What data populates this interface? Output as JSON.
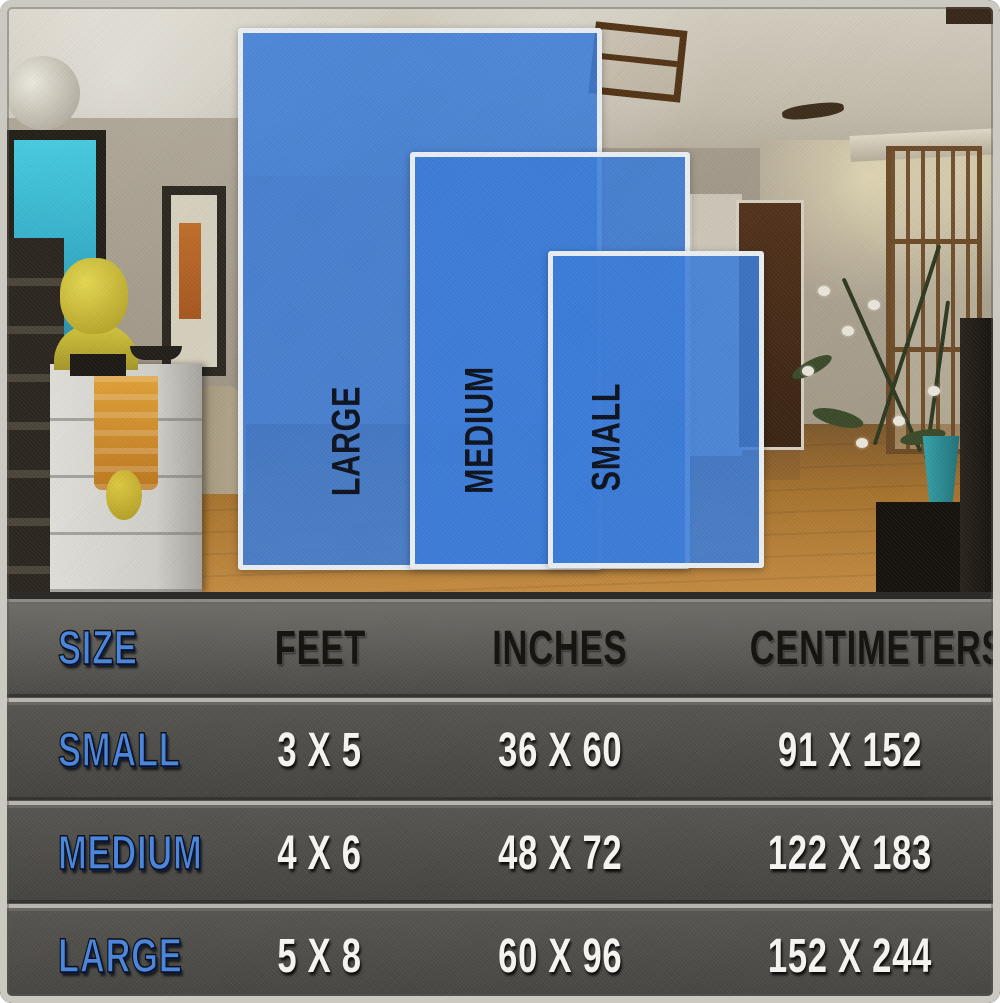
{
  "overlay": {
    "large_label": "LARGE",
    "medium_label": "MEDIUM",
    "small_label": "SMALL"
  },
  "table": {
    "headers": {
      "size": "SIZE",
      "feet": "FEET",
      "inches": "INCHES",
      "centimeters": "CENTIMETERS"
    },
    "rows": [
      {
        "size": "SMALL",
        "feet": "3 X 5",
        "inches": "36 X 60",
        "centimeters": "91 X 152"
      },
      {
        "size": "MEDIUM",
        "feet": "4 X 6",
        "inches": "48 X 72",
        "centimeters": "122 X 183"
      },
      {
        "size": "LARGE",
        "feet": "5 X 8",
        "inches": "60 X 96",
        "centimeters": "152 X 244"
      }
    ]
  },
  "chart_data": {
    "type": "table",
    "title": "Rug size chart",
    "columns": [
      "SIZE",
      "FEET",
      "INCHES",
      "CENTIMETERS"
    ],
    "rows": [
      [
        "SMALL",
        "3 X 5",
        "36 X 60",
        "91 X 152"
      ],
      [
        "MEDIUM",
        "4 X 6",
        "48 X 72",
        "122 X 183"
      ],
      [
        "LARGE",
        "5 X 8",
        "60 X 96",
        "152 X 244"
      ]
    ],
    "legend_position": "none",
    "notes": "Three blue rug-size rectangles (LARGE, MEDIUM, SMALL) overlaid on a living-room photo above the table."
  },
  "colors": {
    "rug_blue": "#3c7edd",
    "rug_border_white": "#edf2f6",
    "label_blue": "#4c86dc",
    "value_white": "#f4f3ef",
    "header_text_black": "#16150f",
    "table_bg_gray": "#4e4d49"
  }
}
